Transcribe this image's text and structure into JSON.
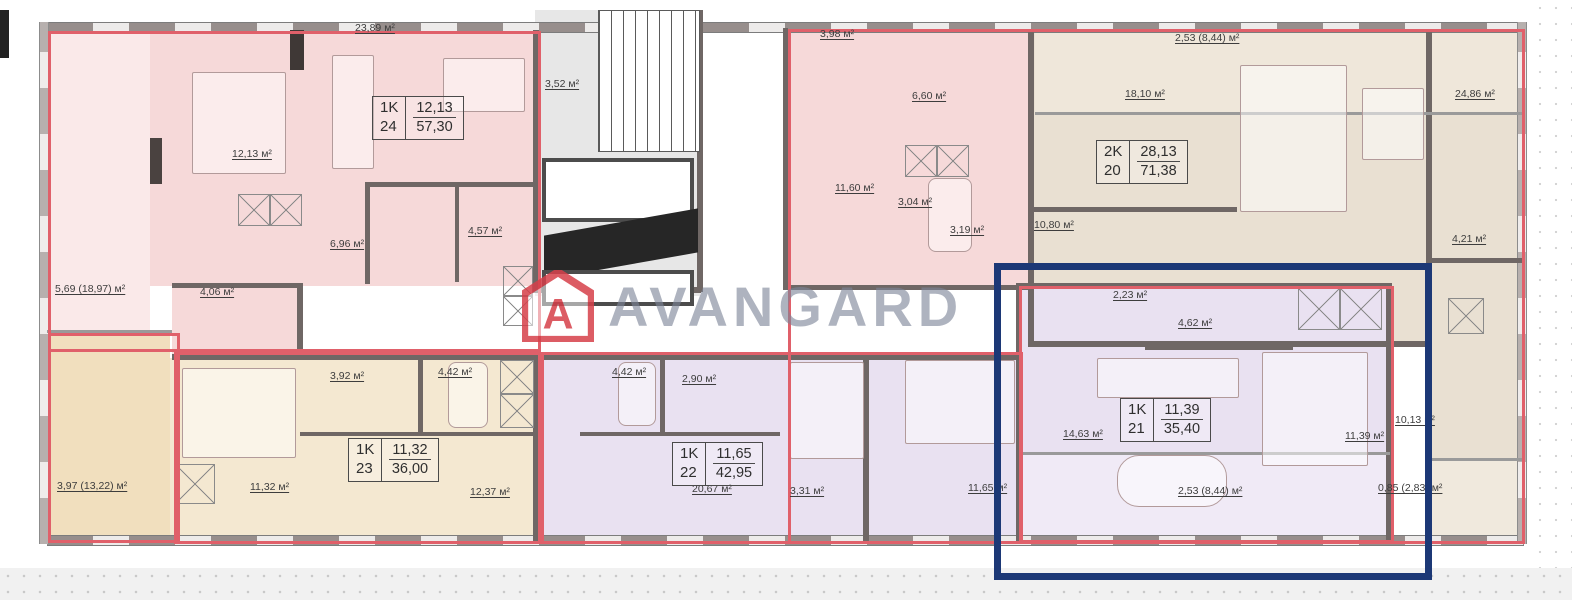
{
  "brand": {
    "name": "AVANGARD",
    "logo_letter": "А"
  },
  "colors": {
    "apartment_outline": "#e0606a",
    "selection_highlight": "#1c3876",
    "brand_red": "#d6404a",
    "watermark_text": "#7c8598"
  },
  "units": [
    {
      "type": "1K",
      "number": "24",
      "living": "12,13",
      "total": "57,30"
    },
    {
      "type": "2K",
      "number": "20",
      "living": "28,13",
      "total": "71,38"
    },
    {
      "type": "1K",
      "number": "23",
      "living": "11,32",
      "total": "36,00"
    },
    {
      "type": "1K",
      "number": "22",
      "living": "11,65",
      "total": "42,95"
    },
    {
      "type": "1K",
      "number": "21",
      "living": "11,39",
      "total": "35,40"
    }
  ],
  "rooms": [
    {
      "text": "23,89 м²"
    },
    {
      "text": "12,13 м²"
    },
    {
      "text": "6,96 м²"
    },
    {
      "text": "4,57 м²"
    },
    {
      "text": "4,06 м²"
    },
    {
      "text": "5,69 (18,97) м²"
    },
    {
      "text": "3,52 м²"
    },
    {
      "text": "3,98 м²"
    },
    {
      "text": "6,60 м²"
    },
    {
      "text": "11,60 м²"
    },
    {
      "text": "3,04 м²"
    },
    {
      "text": "3,19 м²"
    },
    {
      "text": "18,10 м²"
    },
    {
      "text": "10,80 м²"
    },
    {
      "text": "2,53 (8,44) м²"
    },
    {
      "text": "24,86 м²"
    },
    {
      "text": "4,21 м²"
    },
    {
      "text": "3,97 (13,22) м²"
    },
    {
      "text": "11,32 м²"
    },
    {
      "text": "3,92 м²"
    },
    {
      "text": "4,42 м²"
    },
    {
      "text": "12,37 м²"
    },
    {
      "text": "4,42 м²"
    },
    {
      "text": "2,90 м²"
    },
    {
      "text": "20,67 м²"
    },
    {
      "text": "3,31 м²"
    },
    {
      "text": "11,65 м²"
    },
    {
      "text": "2,23 м²"
    },
    {
      "text": "4,62 м²"
    },
    {
      "text": "14,63 м²"
    },
    {
      "text": "11,39 м²"
    },
    {
      "text": "2,53 (8,44) м²"
    },
    {
      "text": "10,13 м²"
    },
    {
      "text": "0,85 (2,83) м²"
    }
  ]
}
